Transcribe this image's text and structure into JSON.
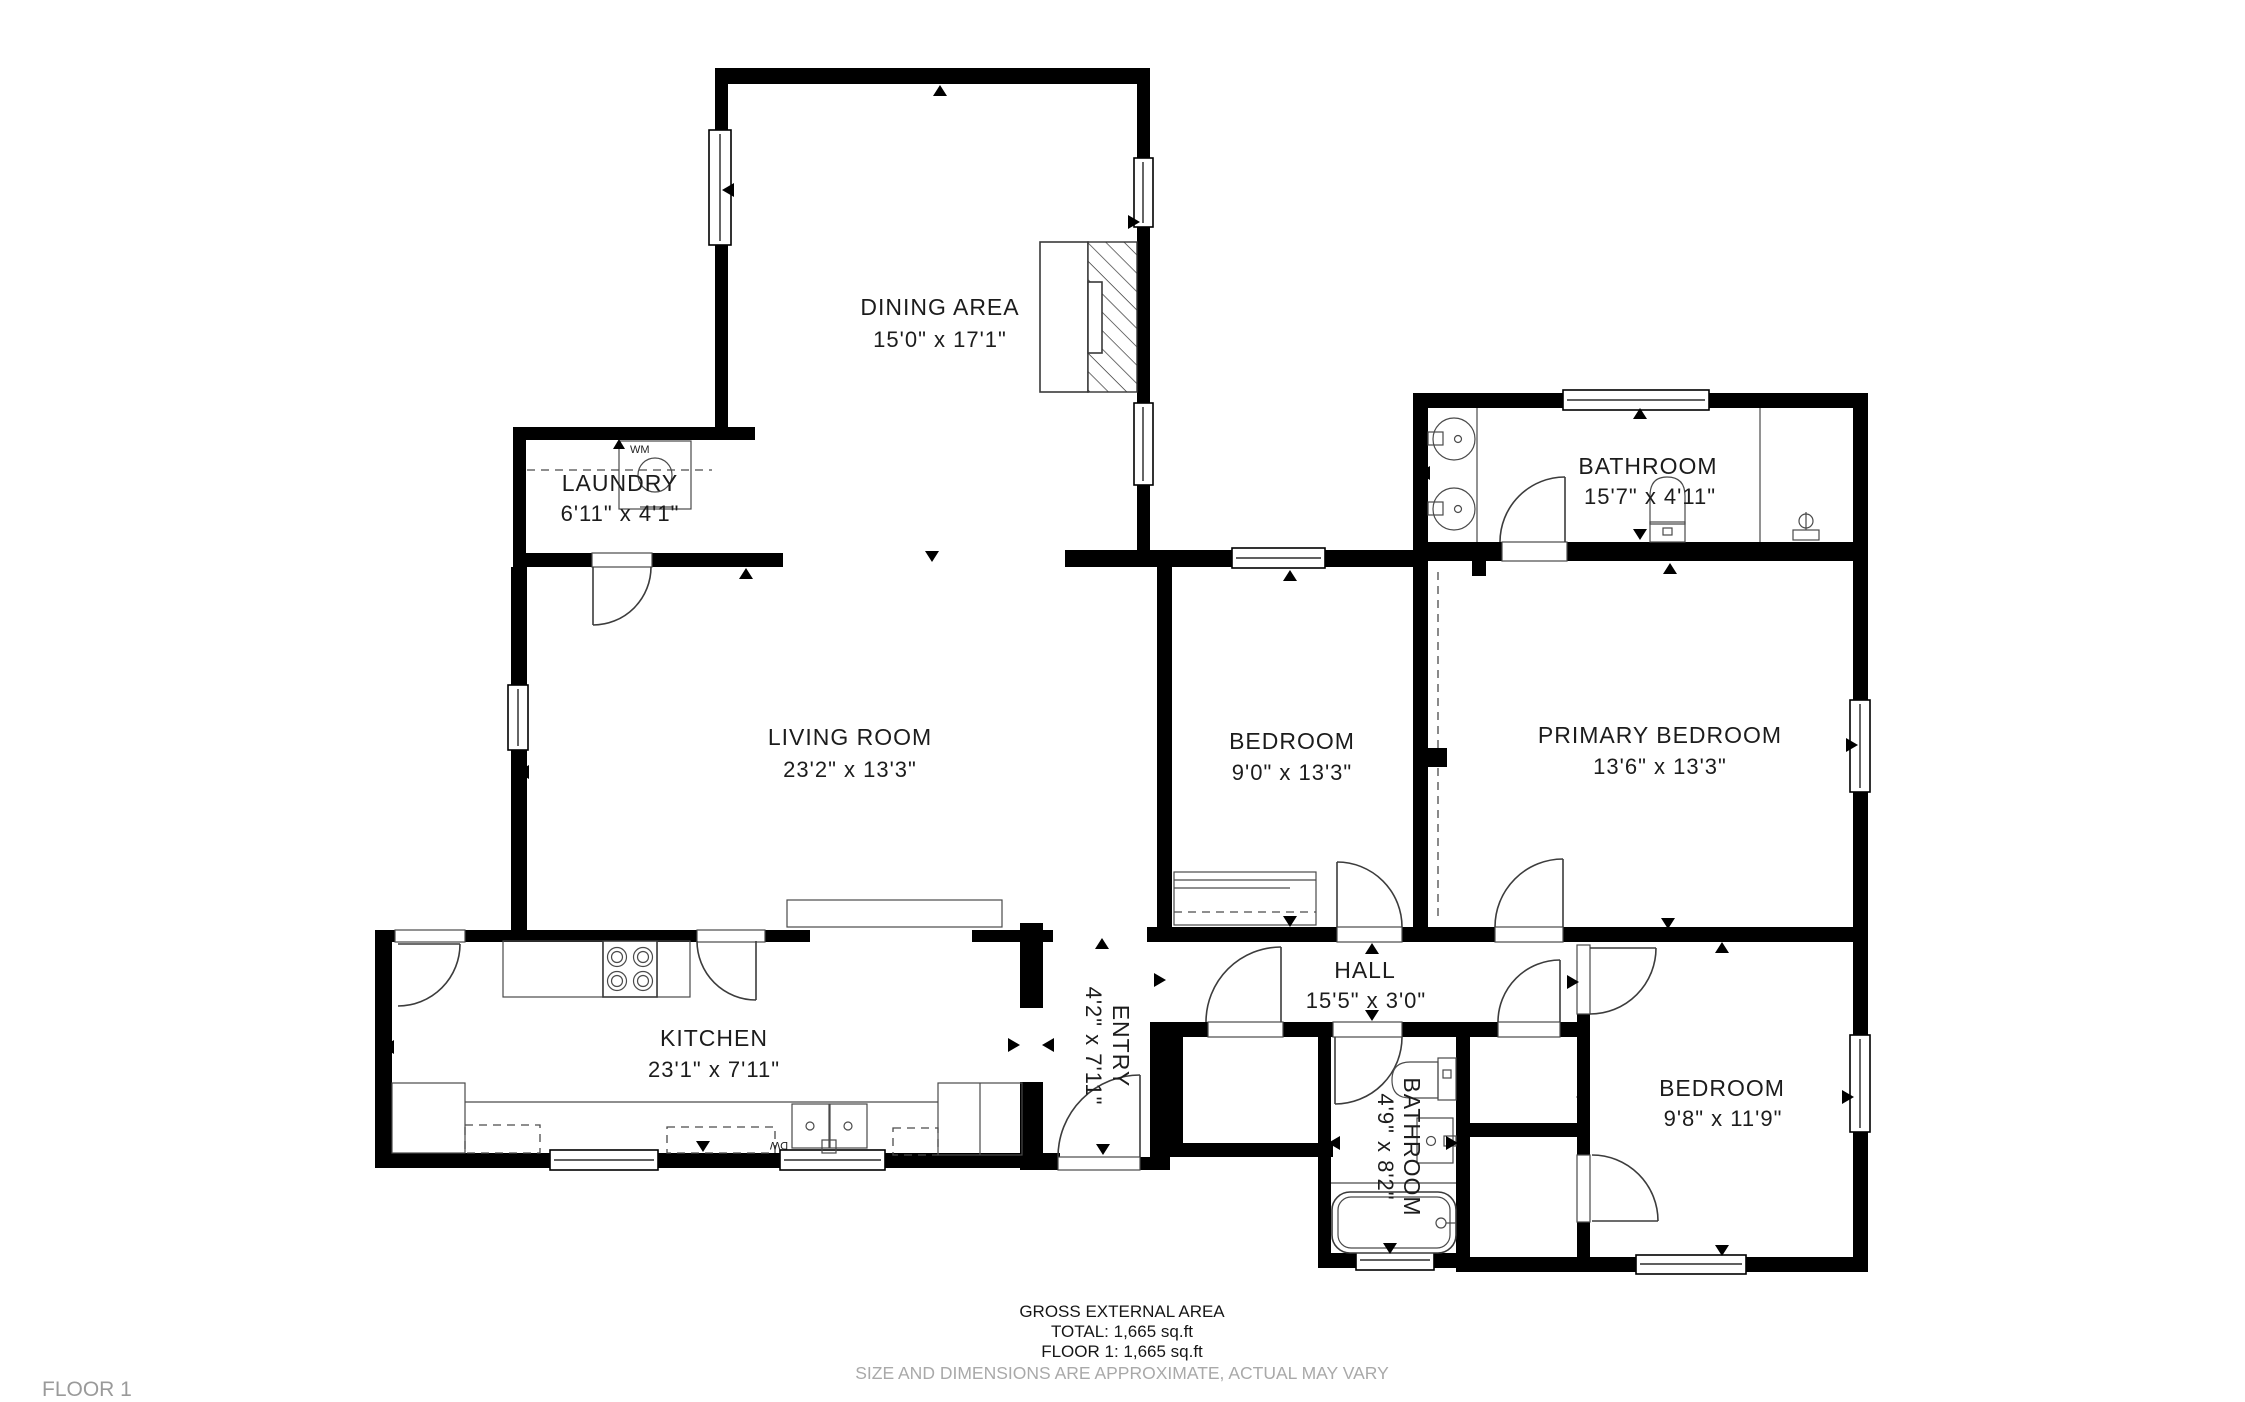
{
  "colors": {
    "background": "#ffffff",
    "walls": "#000000",
    "room_text": "#1c1c1c",
    "muted_text": "#a9a9a9"
  },
  "rooms": [
    {
      "id": "dining-area",
      "name": "DINING AREA",
      "dims": "15'0\" x 17'1\"",
      "rotated": false
    },
    {
      "id": "laundry",
      "name": "LAUNDRY",
      "dims": "6'11\" x 4'1\"",
      "rotated": false
    },
    {
      "id": "living-room",
      "name": "LIVING ROOM",
      "dims": "23'2\" x 13'3\"",
      "rotated": false
    },
    {
      "id": "kitchen",
      "name": "KITCHEN",
      "dims": "23'1\" x 7'11\"",
      "rotated": false
    },
    {
      "id": "entry",
      "name": "ENTRY",
      "dims": "4'2\" x 7'11\"",
      "rotated": true
    },
    {
      "id": "hall",
      "name": "HALL",
      "dims": "15'5\" x 3'0\"",
      "rotated": false
    },
    {
      "id": "bedroom-middle",
      "name": "BEDROOM",
      "dims": "9'0\" x 13'3\"",
      "rotated": false
    },
    {
      "id": "bathroom-top",
      "name": "BATHROOM",
      "dims": "15'7\" x 4'11\"",
      "rotated": false
    },
    {
      "id": "primary-bedroom",
      "name": "PRIMARY BEDROOM",
      "dims": "13'6\" x 13'3\"",
      "rotated": false
    },
    {
      "id": "bathroom-bottom",
      "name": "BATHROOM",
      "dims": "4'9\" x 8'2\"",
      "rotated": true
    },
    {
      "id": "bedroom-right",
      "name": "BEDROOM",
      "dims": "9'8\" x 11'9\"",
      "rotated": false
    }
  ],
  "appliances": {
    "washer": "WM",
    "dishwasher": "DW"
  },
  "fixtures": [
    "fireplace",
    "washing-machine",
    "stove",
    "kitchen-sink",
    "refrigerator",
    "bathroom-sink",
    "toilet",
    "bathtub",
    "shower-valve",
    "wardrobe",
    "sideboard"
  ],
  "footer": {
    "line1": "GROSS EXTERNAL AREA",
    "line2": "TOTAL: 1,665 sq.ft",
    "line3": "FLOOR 1: 1,665 sq.ft",
    "disclaimer": "SIZE AND DIMENSIONS ARE APPROXIMATE, ACTUAL MAY VARY"
  },
  "floor_label": "FLOOR 1"
}
